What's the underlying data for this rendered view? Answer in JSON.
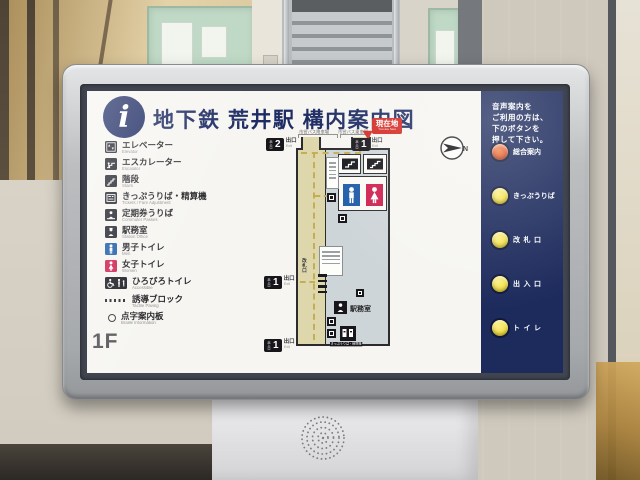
{
  "sign": {
    "info_glyph": "i",
    "title": "地下鉄 荒井駅 構内案内図",
    "floor_label": "1F",
    "colors": {
      "navy": "#1e2c64",
      "panel_navy": "#1c2a5c",
      "you_are_here_red": "#d42a24",
      "men_blue": "#1f5da8",
      "women_red": "#ce2150",
      "corridor_beige": "#ded7ab",
      "rooms_gray": "#ced5d8",
      "button_orange": "#e2572b",
      "button_yellow": "#f2dd3e"
    },
    "legend": {
      "items": [
        {
          "jp": "エレベーター",
          "en": "Elevator",
          "icon": "elevator-icon"
        },
        {
          "jp": "エスカレーター",
          "en": "Escalator",
          "icon": "escalator-icon"
        },
        {
          "jp": "階段",
          "en": "Stairs",
          "icon": "stairs-icon"
        },
        {
          "jp": "きっぷうりば・精算機",
          "en": "Tickets / Fare Adjustment",
          "icon": "tickets-icon"
        },
        {
          "jp": "定期券うりば",
          "en": "Commuter Passes",
          "icon": "commuter-pass-icon"
        },
        {
          "jp": "駅務室",
          "en": "Station Office",
          "icon": "station-office-icon"
        },
        {
          "jp": "男子トイレ",
          "en": "Men",
          "icon": "men-toilet-icon"
        },
        {
          "jp": "女子トイレ",
          "en": "Women",
          "icon": "women-toilet-icon"
        },
        {
          "jp": "ひろびろトイレ",
          "en": "Accessible",
          "icon": "accessible-toilet-icon"
        },
        {
          "jp": "誘導ブロック",
          "en": "Tactile Paving",
          "icon": "tactile-paving-icon"
        },
        {
          "jp": "点字案内板",
          "en": "Braille Information",
          "icon": "braille-icon"
        }
      ]
    },
    "map": {
      "you_are_here_jp": "現在地",
      "you_are_here_en": "You are here",
      "bus_label_left": "市営バス降車場",
      "bus_label_right": "市営バス乗車場",
      "entrance_prefix": "出入口",
      "exit_word": "出口",
      "exit_word_en": "Exit",
      "exit_numbers": [
        "2",
        "1",
        "1",
        "1"
      ],
      "gate_label": "改札口",
      "office_label": "駅務室",
      "machines_label": "きっぷうりば・精算機",
      "compass_n": "N"
    },
    "audio_panel": {
      "instruction_lines": [
        "音声案内を",
        "ご利用の方は、",
        "下のボタンを",
        "押して下さい。"
      ],
      "buttons": [
        {
          "label": "総合案内",
          "color": "#e2572b"
        },
        {
          "label": "きっぷうりば",
          "color": "#f2dd3e"
        },
        {
          "label": "改札口",
          "color": "#f2dd3e"
        },
        {
          "label": "出入口",
          "color": "#f2dd3e"
        },
        {
          "label": "トイレ",
          "color": "#f2dd3e"
        }
      ]
    }
  }
}
